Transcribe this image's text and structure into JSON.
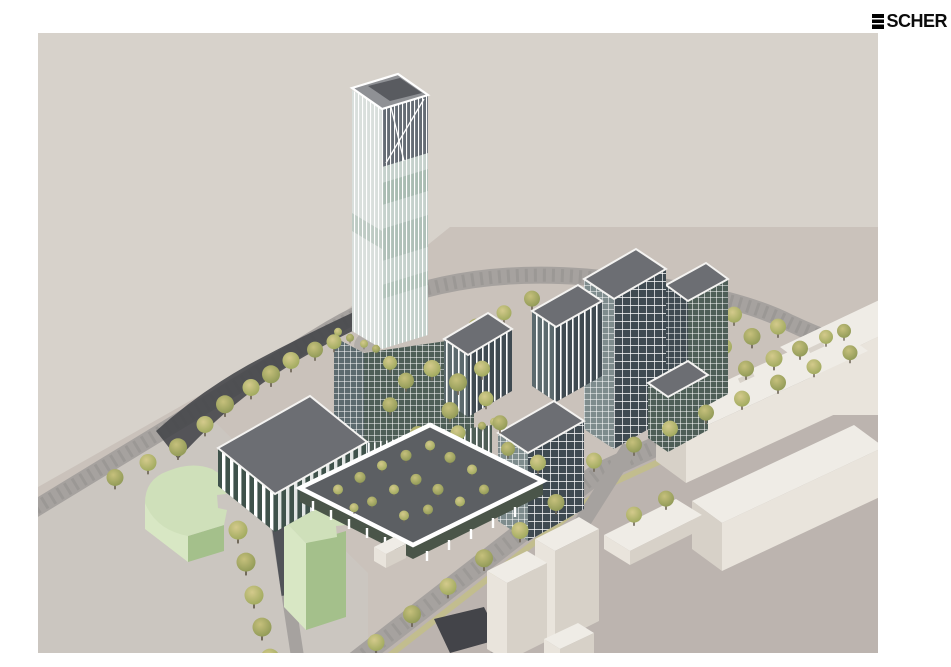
{
  "logo": {
    "mark": "E",
    "text": "SCHER"
  },
  "scene": {
    "alt": "Aerial axonometric architectural rendering: a slender high-rise tower with vertically striped glass facade on a terraced podium, mid-rise office buildings with slanted dark grey roofs and white grid facades, a flat-roofed glass pavilion, a sunken tree-planted garden court, two light green context buildings, white context building massing across tree-lined streets and a curving ring road on beige ground."
  },
  "palette": {
    "sky": "#d7d2cb",
    "ground": "#cac2bb",
    "foreground": "#bcb4af",
    "plaza": "#cbc6c0",
    "road": "#a6a29f",
    "roadTex": "#8f8c89",
    "grassStrip": "#c2bd8e",
    "asphalt": "#434449",
    "roofDark": "#6c6e73",
    "glassDark": "#3f4a51",
    "glassMid": "#5c6a6e",
    "glassGreen": "#4e5e57",
    "glassLight": "#7e8c8d",
    "pavGlass": "#3f524b",
    "whiteTop": "#efece6",
    "whiteLight": "#e9e4dc",
    "whiteShade": "#d7d1c8",
    "greenTop": "#cfe0ba",
    "greenLight": "#d8e7c4",
    "greenShade": "#a4c08b",
    "gardenFloor": "#5c5f63",
    "pergola": "#4a5549",
    "towerLight": "#d9dfdc",
    "towerGlass": "#c5d1cc",
    "towerBand": "#9db3a7",
    "towerCrown": "#59616a",
    "treeOlive": "#8b9653",
    "treeYellow": "#9aa659",
    "trunk": "#6e6557",
    "logo": "#0b0b0b"
  }
}
